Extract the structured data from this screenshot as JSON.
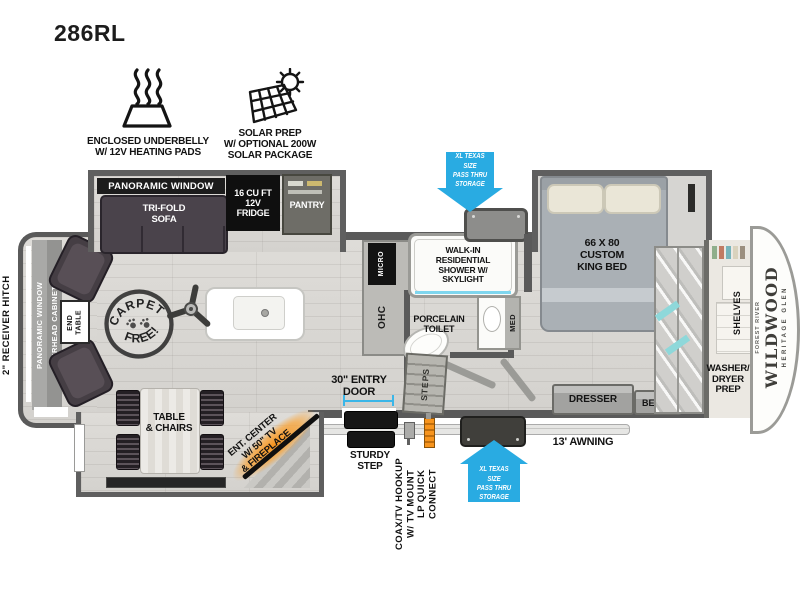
{
  "colors": {
    "arrow_blue": "#29ABE2",
    "accent_orange": "#F7941D",
    "measure_cyan": "#3AB6E8",
    "wall_gray": "#5A5A5A"
  },
  "title": "286RL",
  "features": {
    "underbelly_label": "ENCLOSED UNDERBELLY\nW/ 12V HEATING PADS",
    "solar_label": "SOLAR PREP\nW/ OPTIONAL 200W\nSOLAR PACKAGE"
  },
  "callouts": {
    "pass_thru_top": "XL TEXAS SIZE\nPASS THRU\nSTORAGE",
    "pass_thru_bottom": "XL TEXAS SIZE\nPASS THRU\nSTORAGE",
    "receiver_hitch": "2\" RECEIVER HITCH",
    "entry_door": "30\" ENTRY\nDOOR",
    "sturdy_step": "STURDY\nSTEP",
    "coax": "COAX/TV HOOKUP\nW/ TV MOUNT",
    "lp_quick_connect": "LP QUICK\nCONNECT",
    "awning": "13' AWNING"
  },
  "living": {
    "slide_window": "PANORAMIC WINDOW",
    "sofa": "TRI-FOLD\nSOFA",
    "fridge": "16 CU FT\n12V\nFRIDGE",
    "pantry": "PANTRY",
    "rear_window": "PANORAMIC WINDOW",
    "overhead_cabinets": "OVERHEAD CABINETS",
    "end_table": "END\nTABLE",
    "carpet_top": "CARPET",
    "carpet_bottom": "FREE!",
    "table_chairs": "TABLE\n& CHAIRS",
    "ent_center": "ENT. CENTER\nW/ 50\" TV\n& FIREPLACE"
  },
  "kitchen": {
    "micro": "MICRO",
    "ohc": "OHC"
  },
  "bath": {
    "shower": "WALK-IN\nRESIDENTIAL\nSHOWER W/\nSKYLIGHT",
    "toilet": "PORCELAIN\nTOILET",
    "med": "MED",
    "steps": "STEPS"
  },
  "bedroom": {
    "bed": "66 X 80\nCUSTOM\nKING BED",
    "dresser": "DRESSER",
    "bench": "BENCH",
    "shelves": "SHELVES",
    "washer_dryer": "WASHER/\nDRYER\nPREP"
  },
  "brand": {
    "maker": "FOREST RIVER",
    "name": "WILDWOOD",
    "series": "HERITAGE GLEN"
  }
}
